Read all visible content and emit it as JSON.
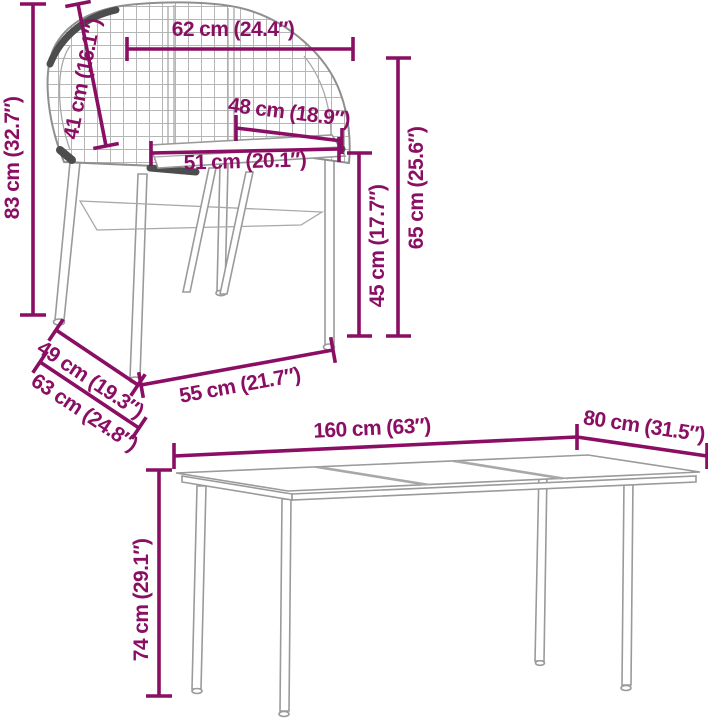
{
  "diagram_title": "garden furniture dimension diagram",
  "accent_color": "#8A0E63",
  "furniture_line_color": "#9a9a9a",
  "chair": {
    "item": "wicker chair",
    "dims": [
      {
        "id": "total-height",
        "label": "83 cm (32.7″)"
      },
      {
        "id": "back-height",
        "label": "41 cm (16.1″)"
      },
      {
        "id": "top-width",
        "label": "62 cm (24.4″)"
      },
      {
        "id": "seat-depth-width",
        "label": "48 cm (18.9″)"
      },
      {
        "id": "seat-width",
        "label": "51 cm (20.1″)"
      },
      {
        "id": "arm-height",
        "label": "65 cm (25.6″)"
      },
      {
        "id": "seat-height",
        "label": "45 cm (17.7″)"
      },
      {
        "id": "depth-upper",
        "label": "49 cm (19.3″)"
      },
      {
        "id": "depth-total",
        "label": "63 cm (24.8″)"
      },
      {
        "id": "base-width",
        "label": "55 cm (21.7″)"
      }
    ]
  },
  "table": {
    "item": "garden dining table",
    "dims": [
      {
        "id": "length",
        "label": "160 cm (63″)"
      },
      {
        "id": "width",
        "label": "80 cm (31.5″)"
      },
      {
        "id": "height",
        "label": "74 cm (29.1″)"
      }
    ]
  }
}
